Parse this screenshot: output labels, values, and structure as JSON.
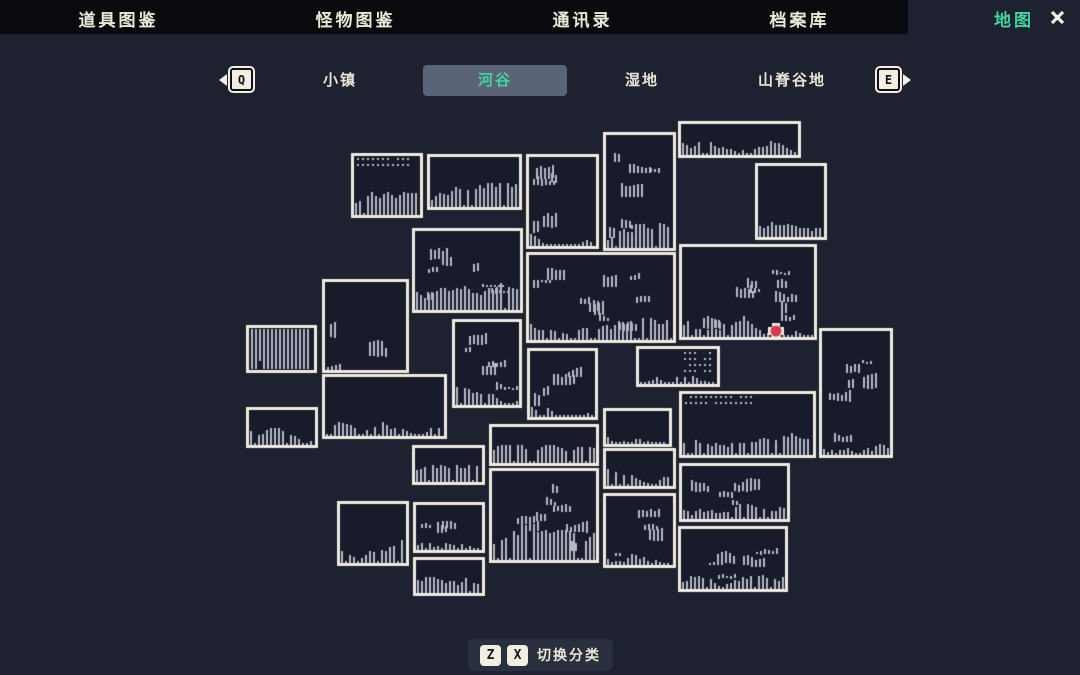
{
  "top_nav": {
    "items": [
      {
        "label": "道具图鉴"
      },
      {
        "label": "怪物图鉴"
      },
      {
        "label": "通讯录"
      },
      {
        "label": "档案库"
      }
    ],
    "active_label": "地图"
  },
  "tab_bar": {
    "prev_key": "Q",
    "next_key": "E",
    "tabs": [
      {
        "label": "小镇",
        "selected": false
      },
      {
        "label": "河谷",
        "selected": true
      },
      {
        "label": "湿地",
        "selected": false
      },
      {
        "label": "山脊谷地",
        "selected": false
      }
    ]
  },
  "footer": {
    "keys": [
      "Z",
      "X"
    ],
    "label": "切换分类"
  },
  "colors": {
    "background": "#1d2130",
    "topbar": "#0a0b0f",
    "accent_green": "#41d69c",
    "selected_tab_bg": "#5a6378",
    "nav_text": "#ece8d8"
  },
  "map": {
    "colors": {
      "room_fill": "#171b2a",
      "border": "#efecdf",
      "pattern": "#b5b9c6",
      "marker": "#d23b55",
      "marker_halo": "#f2efe2"
    },
    "marker": {
      "x": 776,
      "y": 331
    },
    "rooms": [
      {
        "x": 351,
        "y": 153,
        "w": 72,
        "h": 65,
        "p": "dots-top"
      },
      {
        "x": 427,
        "y": 154,
        "w": 95,
        "h": 56,
        "p": "terrain"
      },
      {
        "x": 526,
        "y": 154,
        "w": 73,
        "h": 95,
        "p": "scatter"
      },
      {
        "x": 603,
        "y": 132,
        "w": 73,
        "h": 119,
        "p": "scatter"
      },
      {
        "x": 678,
        "y": 121,
        "w": 123,
        "h": 37,
        "p": "terrain"
      },
      {
        "x": 755,
        "y": 163,
        "w": 72,
        "h": 77,
        "p": "terrain"
      },
      {
        "x": 412,
        "y": 228,
        "w": 111,
        "h": 85,
        "p": "scatter"
      },
      {
        "x": 679,
        "y": 244,
        "w": 138,
        "h": 96,
        "p": "scatter"
      },
      {
        "x": 819,
        "y": 328,
        "w": 74,
        "h": 130,
        "p": "scatter"
      },
      {
        "x": 526,
        "y": 252,
        "w": 150,
        "h": 91,
        "p": "scatter"
      },
      {
        "x": 322,
        "y": 279,
        "w": 87,
        "h": 94,
        "p": "sparse"
      },
      {
        "x": 246,
        "y": 325,
        "w": 71,
        "h": 48,
        "p": "stripes"
      },
      {
        "x": 452,
        "y": 319,
        "w": 70,
        "h": 89,
        "p": "scatter"
      },
      {
        "x": 527,
        "y": 348,
        "w": 71,
        "h": 72,
        "p": "scatter"
      },
      {
        "x": 636,
        "y": 346,
        "w": 84,
        "h": 41,
        "p": "dots-right"
      },
      {
        "x": 679,
        "y": 391,
        "w": 137,
        "h": 67,
        "p": "dots-top"
      },
      {
        "x": 603,
        "y": 408,
        "w": 69,
        "h": 39,
        "p": "terrain"
      },
      {
        "x": 603,
        "y": 448,
        "w": 73,
        "h": 41,
        "p": "terrain"
      },
      {
        "x": 603,
        "y": 493,
        "w": 73,
        "h": 75,
        "p": "scatter"
      },
      {
        "x": 246,
        "y": 407,
        "w": 72,
        "h": 41,
        "p": "terrain"
      },
      {
        "x": 322,
        "y": 374,
        "w": 125,
        "h": 65,
        "p": "terrain"
      },
      {
        "x": 412,
        "y": 445,
        "w": 73,
        "h": 40,
        "p": "terrain"
      },
      {
        "x": 489,
        "y": 424,
        "w": 110,
        "h": 42,
        "p": "terrain"
      },
      {
        "x": 489,
        "y": 468,
        "w": 110,
        "h": 95,
        "p": "scatter"
      },
      {
        "x": 337,
        "y": 501,
        "w": 72,
        "h": 65,
        "p": "terrain"
      },
      {
        "x": 413,
        "y": 502,
        "w": 72,
        "h": 51,
        "p": "scatter"
      },
      {
        "x": 413,
        "y": 557,
        "w": 72,
        "h": 39,
        "p": "terrain"
      },
      {
        "x": 679,
        "y": 463,
        "w": 111,
        "h": 59,
        "p": "scatter"
      },
      {
        "x": 678,
        "y": 526,
        "w": 110,
        "h": 66,
        "p": "scatter"
      }
    ]
  }
}
